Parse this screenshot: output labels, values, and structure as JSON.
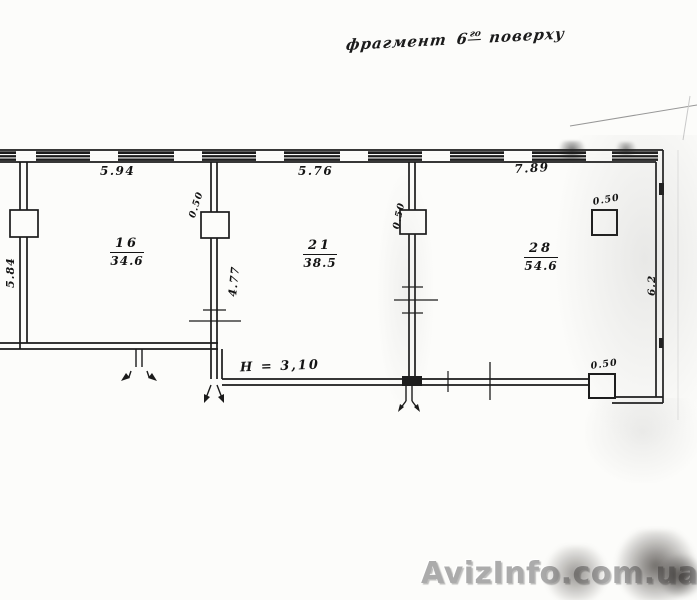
{
  "annotation": {
    "prefix": "фрагмент",
    "floor_number": "6",
    "floor_ordinal": "го",
    "suffix": "поверху"
  },
  "plan": {
    "ceiling_height_note": "H = 3,10",
    "rooms": [
      {
        "number": "16",
        "area": "34.6"
      },
      {
        "number": "21",
        "area": "38.5"
      },
      {
        "number": "28",
        "area": "54.6"
      }
    ],
    "dimensions": {
      "top_wall_room16": "5.94",
      "top_wall_room21": "5.76",
      "top_wall_room28": "7.89",
      "left_wall": "5.84",
      "divider1_pilaster": "0.50",
      "divider1_wall": "4.77",
      "divider2_pilaster": "0.50",
      "column_upper": "0.50",
      "column_lower": "0.50",
      "right_wall": "6.2"
    },
    "ink_color": "#1b1b1b"
  },
  "watermark": {
    "text": "AvizInfo.com.ua",
    "color": "#ababab"
  }
}
